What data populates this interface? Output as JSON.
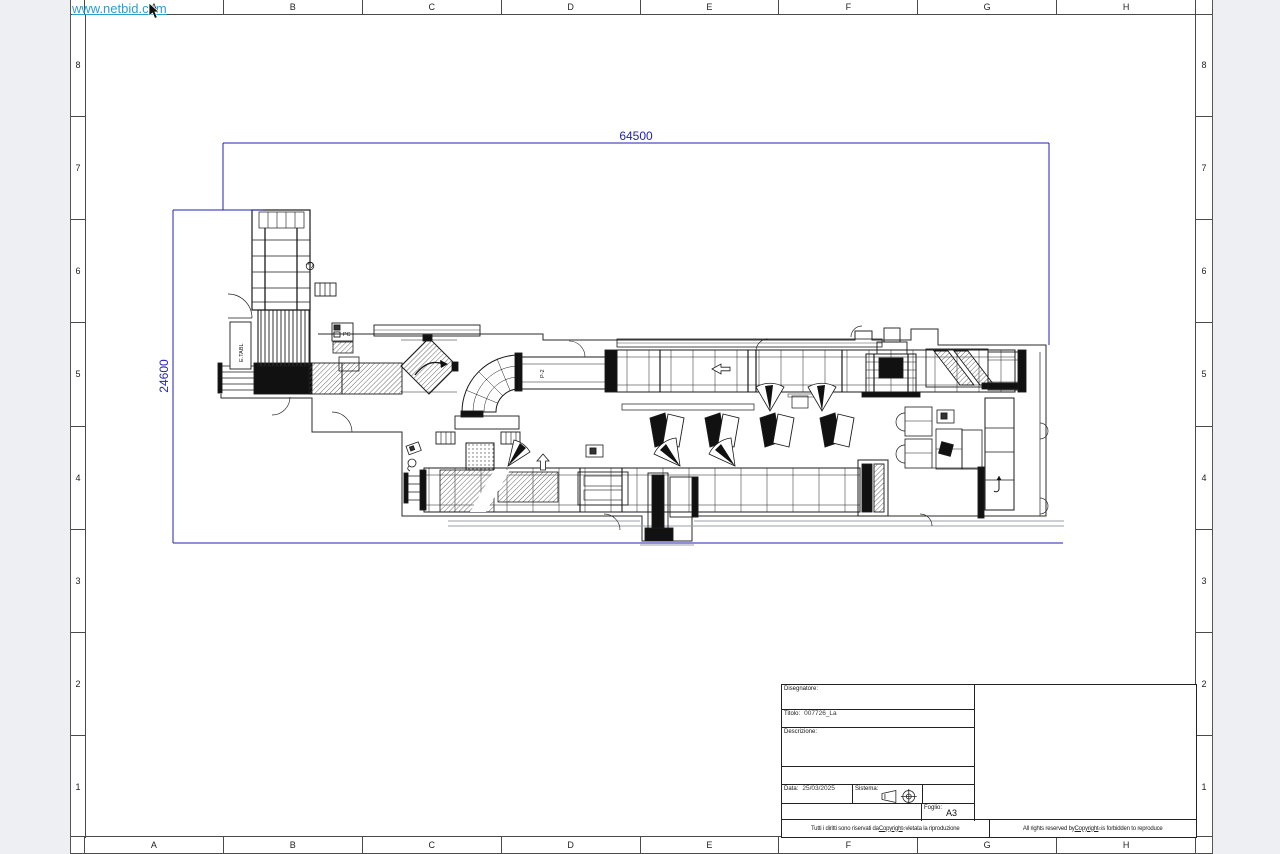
{
  "watermark": {
    "text": "www.netbid.com",
    "color": "#2e9fc8"
  },
  "colors": {
    "page_bg": "#edeff3",
    "paper": "#ffffff",
    "line": "#1b1b1b",
    "dimension_blue": "#2222b0"
  },
  "grid": {
    "columns": [
      "A",
      "B",
      "C",
      "D",
      "E",
      "F",
      "G",
      "H"
    ],
    "rows": [
      "8",
      "7",
      "6",
      "5",
      "4",
      "3",
      "2",
      "1"
    ]
  },
  "dimensions": {
    "width": "64500",
    "height": "24600"
  },
  "drawing_labels": {
    "etabl": "E.TABL",
    "pc": "PC",
    "p2": "P-2"
  },
  "title_block": {
    "disegnatore_label": "Disegnatore:",
    "titolo_label": "Titolo:",
    "titolo_value": "007726_La",
    "descrizione_label": "Descrizione:",
    "data_label": "Data:",
    "data_value": "25/03/2025",
    "sistema_label": "Sistema:",
    "foglio_label": "Foglio:",
    "foglio_value": "A3",
    "copyright_it": {
      "pre": "Tutti i diritti sono riservati da ",
      "word": "Copyright",
      "sup": "©",
      "post": " vietata la riproduzione"
    },
    "copyright_en": {
      "pre": "All rights reserved by ",
      "word": "Copyright",
      "sup": "©",
      "post": " is forbidden to reproduce"
    }
  }
}
